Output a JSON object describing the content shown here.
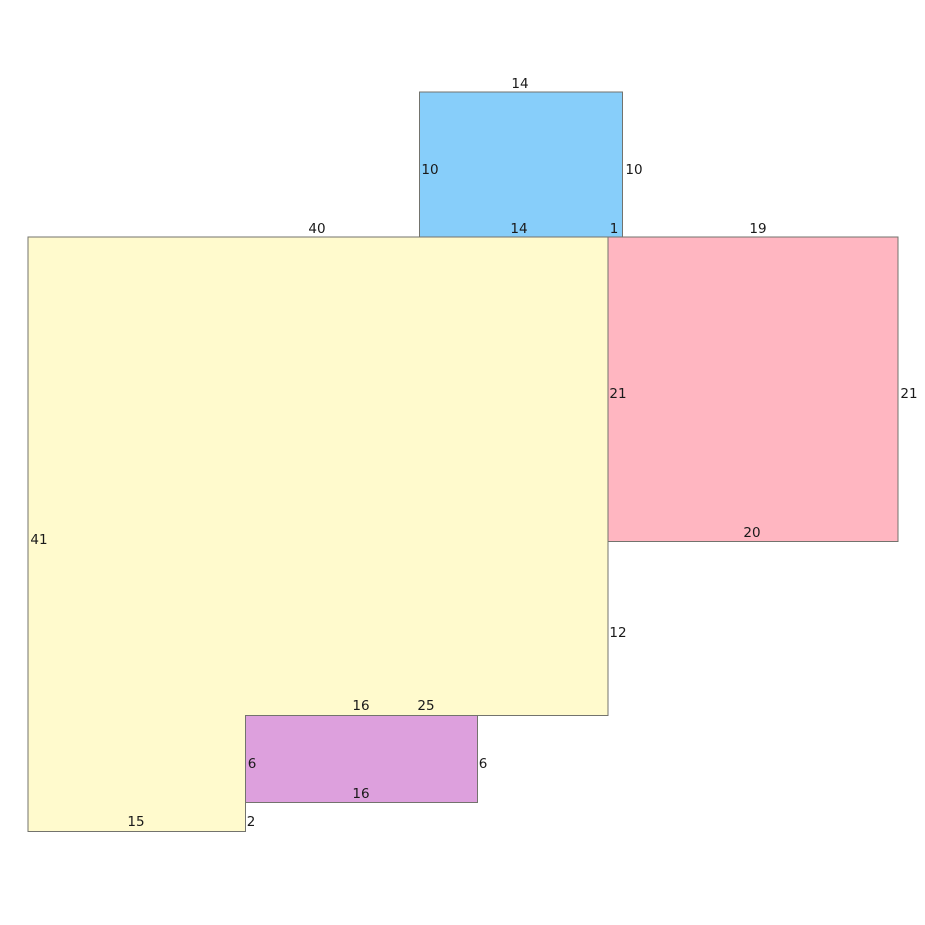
{
  "figure": {
    "canvas": {
      "width": 925,
      "height": 925,
      "background": "#ffffff"
    },
    "stroke": {
      "color": "#73736d",
      "width": 1
    },
    "text_color": "#1a1a1a",
    "shapes": [
      {
        "id": "yellow-polygon",
        "type": "polygon",
        "fill": "#FFFACD",
        "points": [
          [
            28,
            237
          ],
          [
            608,
            237
          ],
          [
            608,
            715.5
          ],
          [
            245.5,
            715.5
          ],
          [
            245.5,
            831.5
          ],
          [
            28,
            831.5
          ]
        ],
        "edge_lengths": {
          "top": 40,
          "left": 41,
          "bottom_left": 15,
          "right_lower_segment": 12,
          "bottom_right_segment": 25,
          "notch_below_purple": 2
        }
      },
      {
        "id": "blue-rectangle",
        "type": "polygon",
        "fill": "#87CEFA",
        "points": [
          [
            419.5,
            92
          ],
          [
            622.5,
            92
          ],
          [
            622.5,
            237
          ],
          [
            419.5,
            237
          ]
        ],
        "edge_lengths": {
          "top": 14,
          "left": 10,
          "right": 10,
          "bottom": 14,
          "overlap_with_pink": 1
        }
      },
      {
        "id": "pink-rectangle",
        "type": "polygon",
        "fill": "#FFB6C1",
        "points": [
          [
            608,
            237
          ],
          [
            898,
            237
          ],
          [
            898,
            541.5
          ],
          [
            608,
            541.5
          ]
        ],
        "edge_lengths": {
          "top": 19,
          "left": 21,
          "right": 21,
          "bottom": 20
        }
      },
      {
        "id": "purple-rectangle",
        "type": "polygon",
        "fill": "#DDA0DD",
        "points": [
          [
            245.5,
            715.5
          ],
          [
            477.5,
            715.5
          ],
          [
            477.5,
            802.5
          ],
          [
            245.5,
            802.5
          ]
        ],
        "edge_lengths": {
          "top": 16,
          "left": 6,
          "right": 6,
          "bottom": 16
        }
      }
    ],
    "edge_labels": [
      {
        "text": "14",
        "x": 520,
        "y": 84,
        "refers_to": "blue-top"
      },
      {
        "text": "10",
        "x": 430,
        "y": 170,
        "refers_to": "blue-left"
      },
      {
        "text": "10",
        "x": 634,
        "y": 170,
        "refers_to": "blue-right"
      },
      {
        "text": "40",
        "x": 317,
        "y": 229,
        "refers_to": "yellow-top"
      },
      {
        "text": "14",
        "x": 519,
        "y": 229,
        "refers_to": "blue-bottom"
      },
      {
        "text": "1",
        "x": 614,
        "y": 229,
        "refers_to": "blue-pink-overlap"
      },
      {
        "text": "19",
        "x": 758,
        "y": 229,
        "refers_to": "pink-top"
      },
      {
        "text": "21",
        "x": 618,
        "y": 394,
        "refers_to": "pink-left"
      },
      {
        "text": "21",
        "x": 909,
        "y": 394,
        "refers_to": "pink-right"
      },
      {
        "text": "20",
        "x": 752,
        "y": 533,
        "refers_to": "pink-bottom"
      },
      {
        "text": "41",
        "x": 39,
        "y": 540,
        "refers_to": "yellow-left"
      },
      {
        "text": "12",
        "x": 618,
        "y": 633,
        "refers_to": "yellow-right-lower"
      },
      {
        "text": "16",
        "x": 361,
        "y": 706,
        "refers_to": "purple-top"
      },
      {
        "text": "25",
        "x": 426,
        "y": 706,
        "refers_to": "yellow-bottom-right-segment"
      },
      {
        "text": "6",
        "x": 252,
        "y": 764,
        "refers_to": "purple-left"
      },
      {
        "text": "6",
        "x": 483,
        "y": 764,
        "refers_to": "purple-right"
      },
      {
        "text": "16",
        "x": 361,
        "y": 794,
        "refers_to": "purple-bottom"
      },
      {
        "text": "15",
        "x": 136,
        "y": 822,
        "refers_to": "yellow-bottom-left"
      },
      {
        "text": "2",
        "x": 251,
        "y": 822,
        "refers_to": "yellow-notch-below-purple"
      }
    ]
  }
}
